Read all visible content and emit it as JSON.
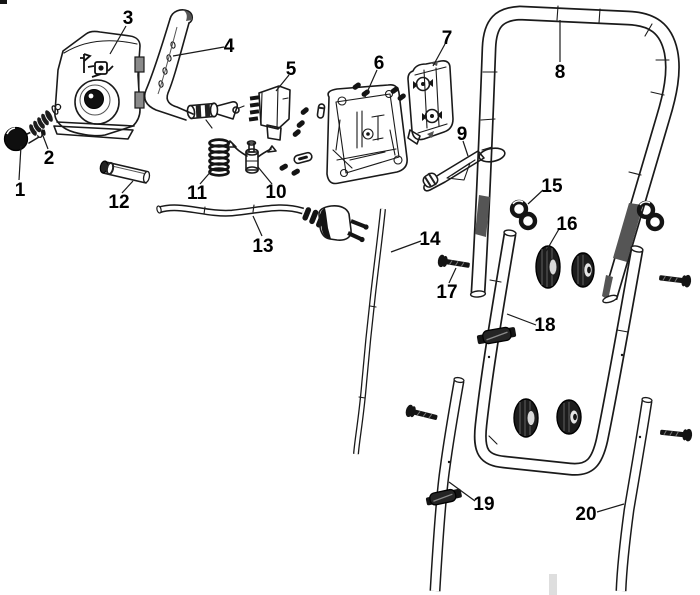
{
  "diagram": {
    "background": "#ffffff",
    "line_color": "#1a1a1a",
    "parts": [
      {
        "number": "1"
      },
      {
        "number": "2"
      },
      {
        "number": "3"
      },
      {
        "number": "4"
      },
      {
        "number": "5"
      },
      {
        "number": "6"
      },
      {
        "number": "7"
      },
      {
        "number": "8"
      },
      {
        "number": "9"
      },
      {
        "number": "10"
      },
      {
        "number": "11"
      },
      {
        "number": "12"
      },
      {
        "number": "13"
      },
      {
        "number": "14"
      },
      {
        "number": "15"
      },
      {
        "number": "16"
      },
      {
        "number": "17"
      },
      {
        "number": "18"
      },
      {
        "number": "19"
      },
      {
        "number": "20"
      }
    ]
  }
}
